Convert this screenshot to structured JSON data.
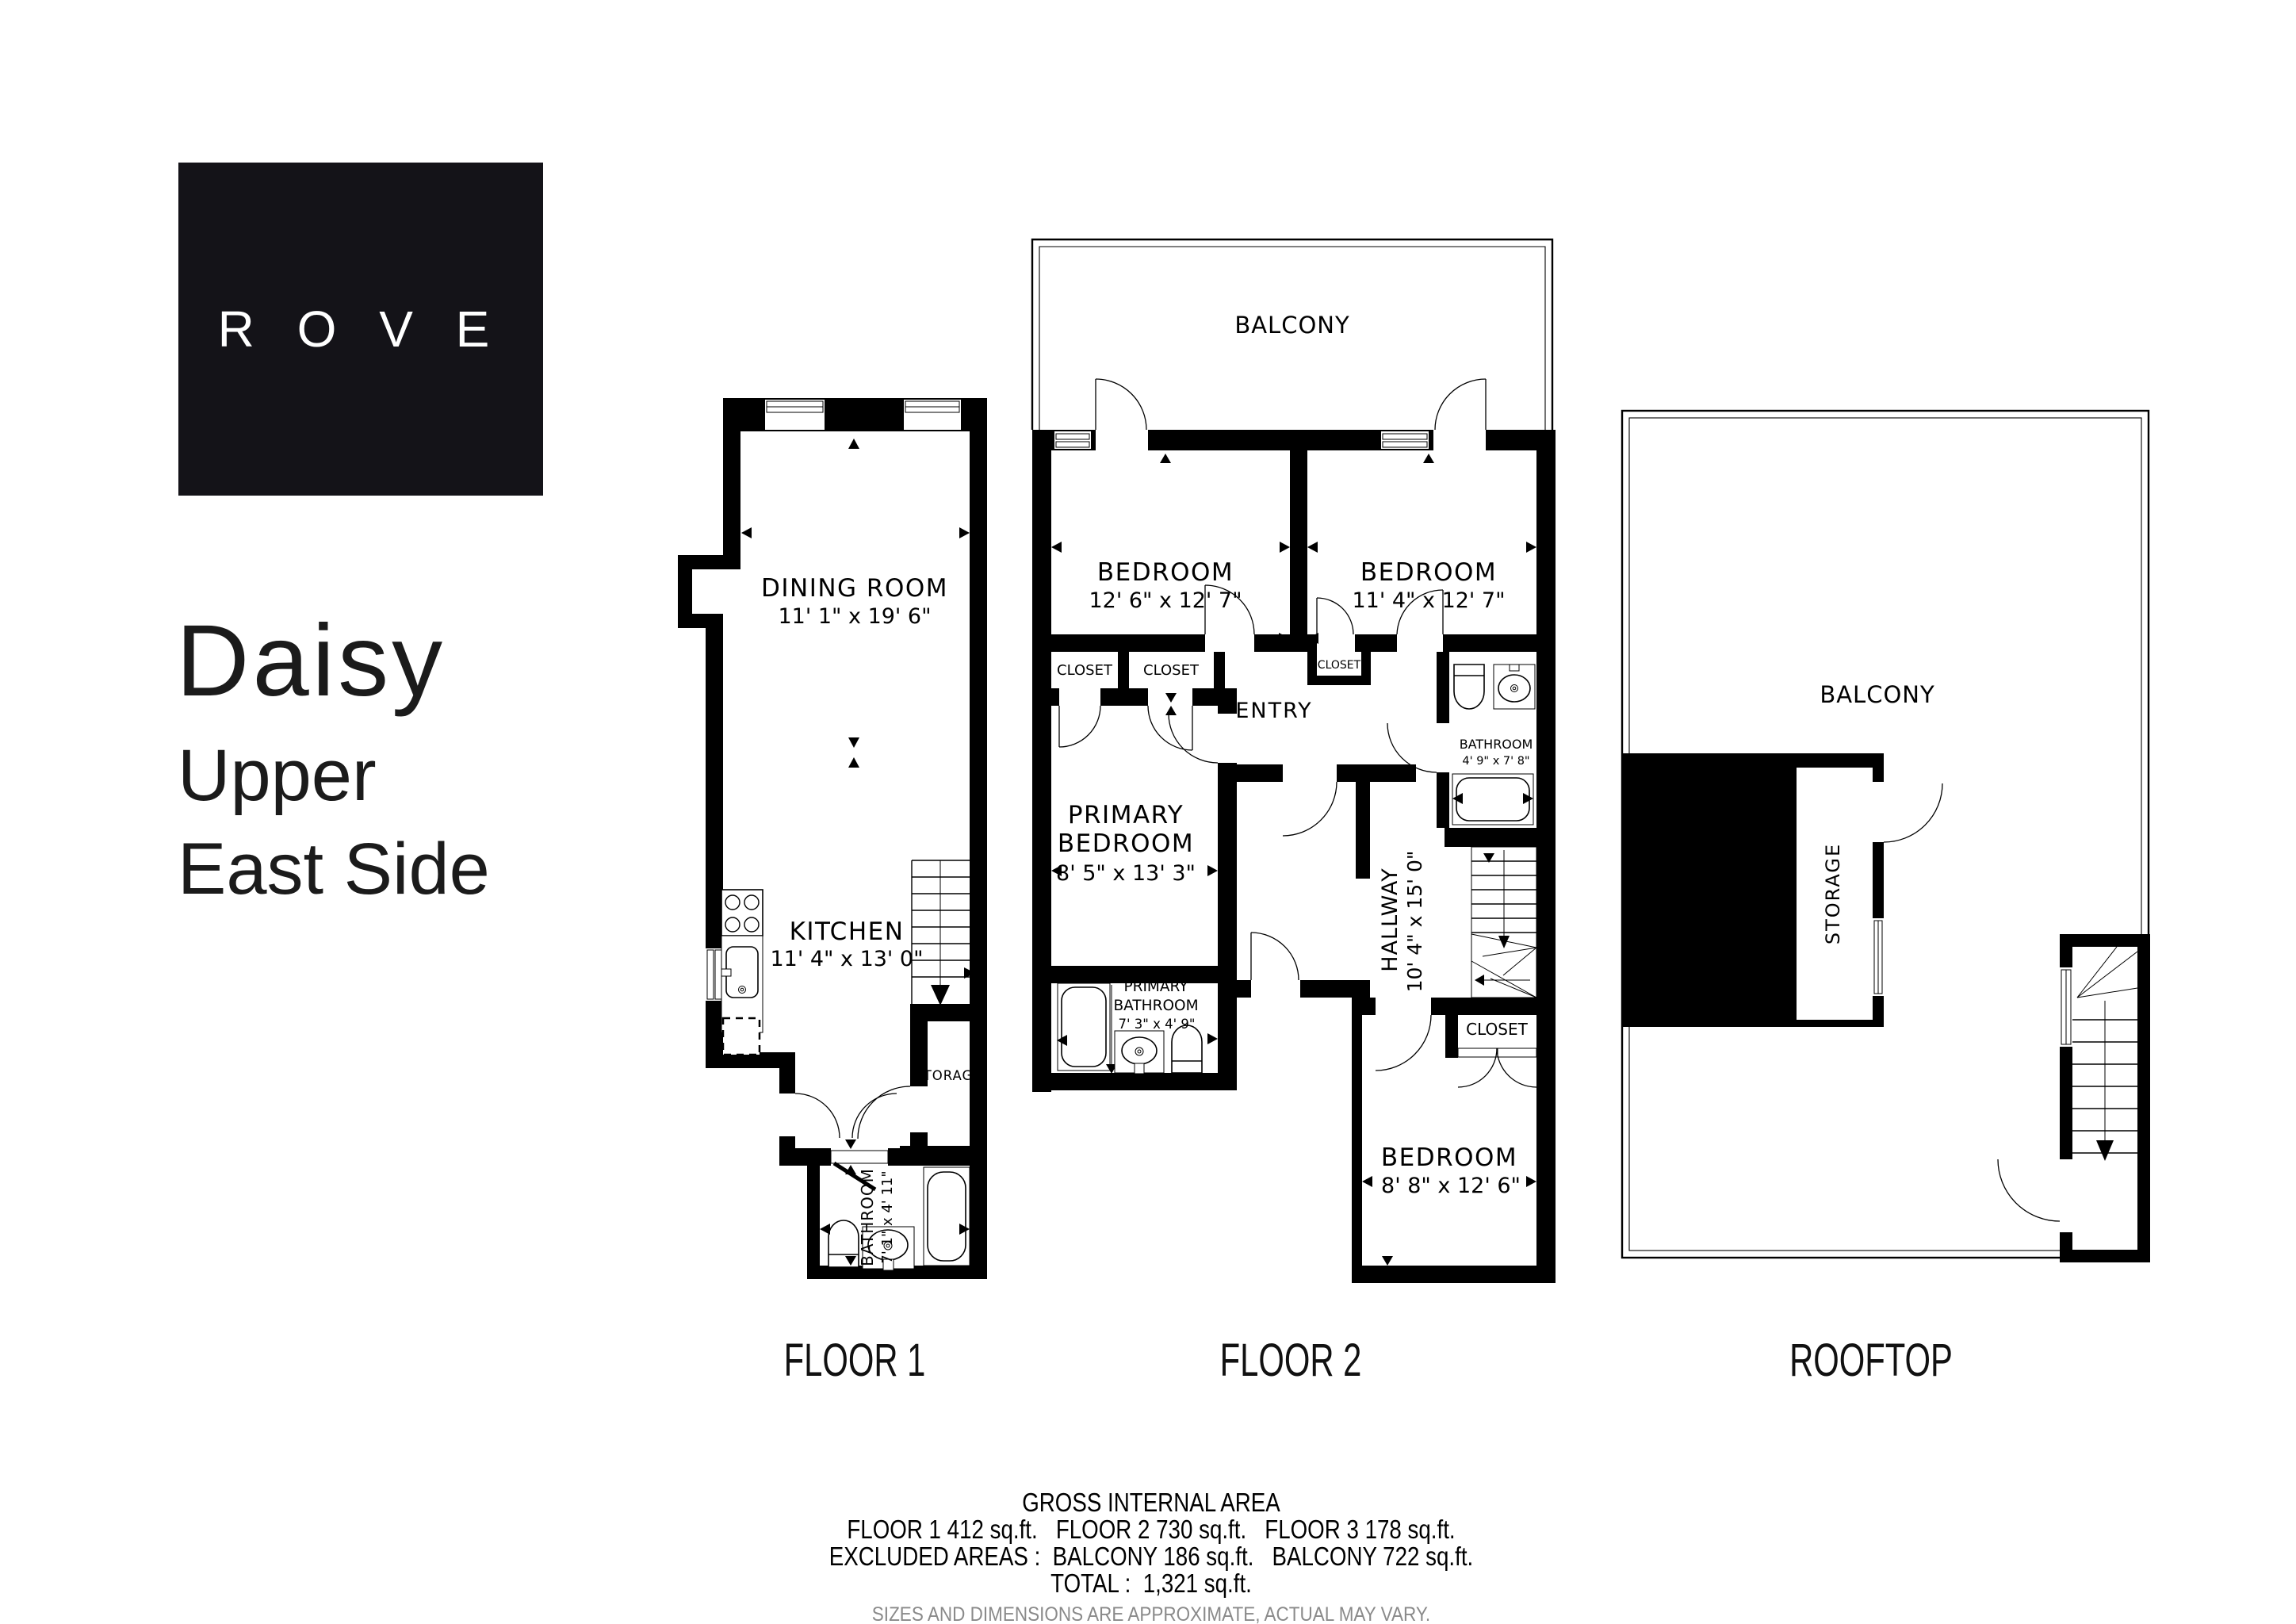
{
  "brand": {
    "logo_text": "R O V E"
  },
  "heading": {
    "title": "Daisy",
    "subtitle_line1": "Upper",
    "subtitle_line2": "East Side"
  },
  "floor1": {
    "label": "FLOOR 1",
    "dining": {
      "name": "DINING ROOM",
      "dims": "11' 1\" x 19' 6\""
    },
    "kitchen": {
      "name": "KITCHEN",
      "dims": "11' 4\" x 13' 0\""
    },
    "storage": {
      "name": "STORAGE"
    },
    "bathroom": {
      "name": "BATHROOM",
      "dims": "7' 1\" x 4' 11\""
    }
  },
  "floor2": {
    "label": "FLOOR 2",
    "balcony": {
      "name": "BALCONY"
    },
    "bedroom_left": {
      "name": "BEDROOM",
      "dims": "12' 6\" x 12' 7\""
    },
    "bedroom_right": {
      "name": "BEDROOM",
      "dims": "11' 4\" x 12' 7\""
    },
    "closet1": {
      "name": "CLOSET"
    },
    "closet2": {
      "name": "CLOSET"
    },
    "closet3": {
      "name": "CLOSET"
    },
    "entry": {
      "name": "ENTRY"
    },
    "bathroom": {
      "name": "BATHROOM",
      "dims": "4' 9\" x 7' 8\""
    },
    "primary_bedroom": {
      "line1": "PRIMARY",
      "line2": "BEDROOM",
      "dims": "8' 5\" x 13' 3\""
    },
    "primary_bathroom": {
      "line1": "PRIMARY",
      "line2": "BATHROOM",
      "dims": "7' 3\" x 4' 9\""
    },
    "hallway": {
      "name": "HALLWAY",
      "dims": "10' 4\" x 15' 0\""
    },
    "closet4": {
      "name": "CLOSET"
    },
    "bedroom_bottom": {
      "name": "BEDROOM",
      "dims": "8' 8\" x 12' 6\""
    }
  },
  "rooftop": {
    "label": "ROOFTOP",
    "balcony": {
      "name": "BALCONY"
    },
    "storage": {
      "name": "STORAGE"
    }
  },
  "footer": {
    "heading": "GROSS INTERNAL AREA",
    "line1": "FLOOR 1 412 sq.ft.   FLOOR 2 730 sq.ft.   FLOOR 3 178 sq.ft.",
    "line2": "EXCLUDED AREAS :  BALCONY 186 sq.ft.   BALCONY 722 sq.ft.",
    "line3": "TOTAL :  1,321 sq.ft.",
    "disclaimer": "SIZES AND DIMENSIONS ARE APPROXIMATE, ACTUAL MAY VARY."
  },
  "colors": {
    "wall": "#000000",
    "muted": "#8a8a8a",
    "logo_bg": "#141318",
    "logo_text": "#ffffff"
  }
}
